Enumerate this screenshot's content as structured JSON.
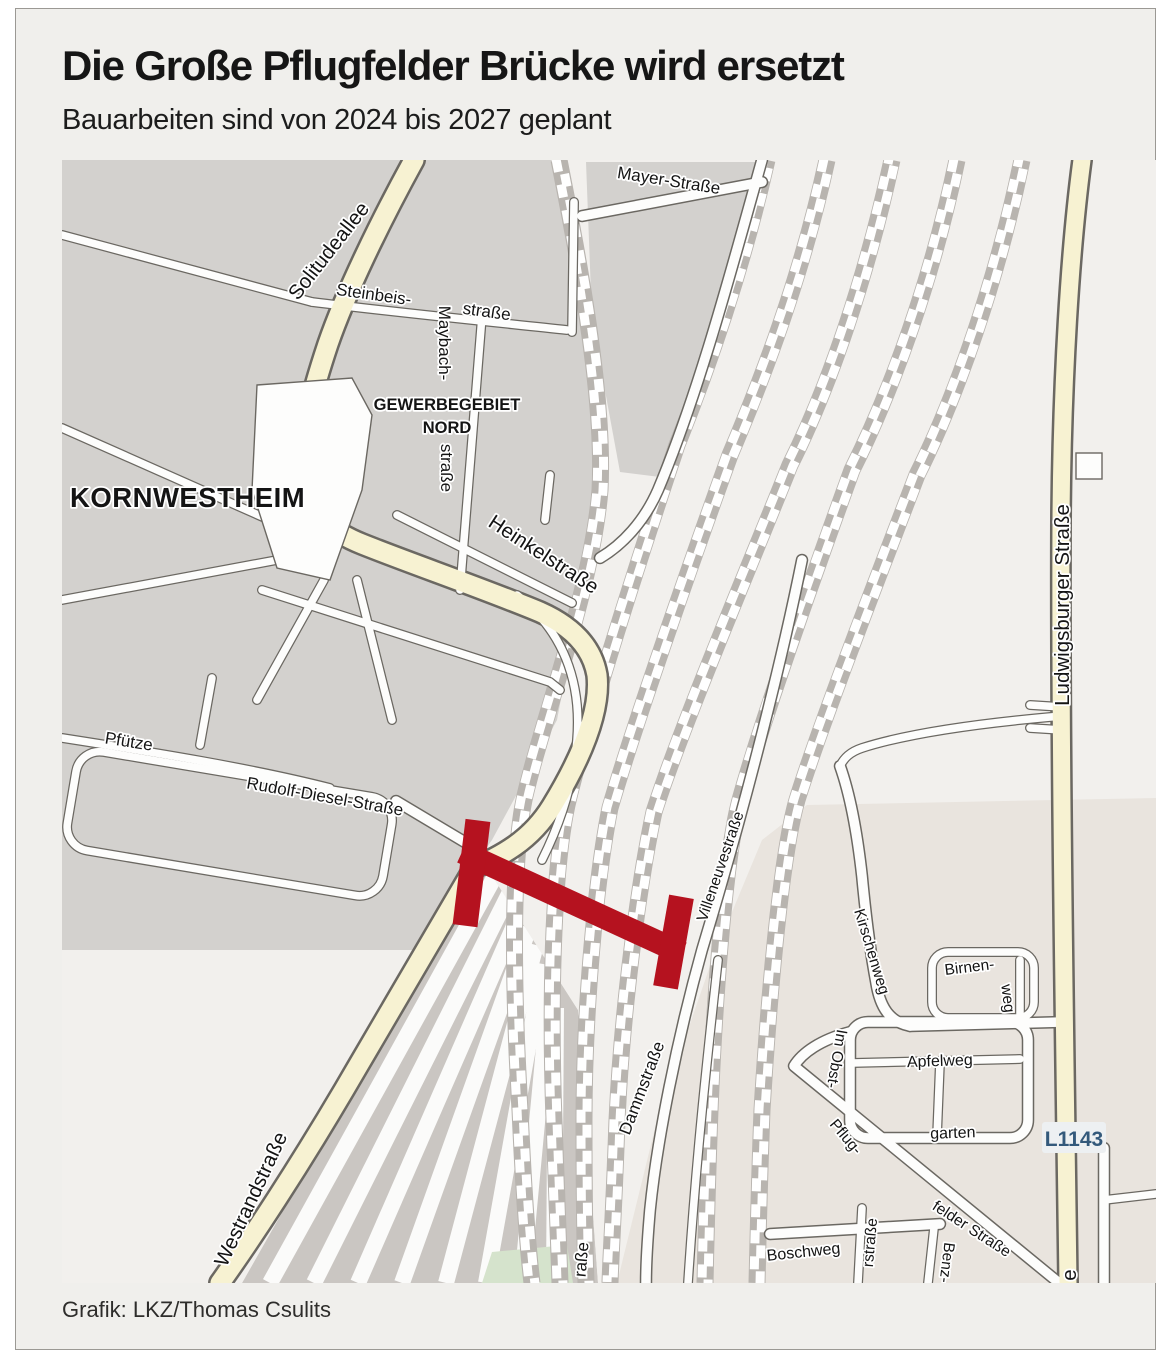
{
  "header": {
    "title": "Die Große Pflugfelder Brücke wird ersetzt",
    "subtitle": "Bauarbeiten sind von 2024 bis 2027 geplant"
  },
  "footer": {
    "credit": "Grafik: LKZ/Thomas Csulits"
  },
  "map": {
    "labels": [
      {
        "text": "Solitudeallee"
      },
      {
        "text": "Steinbeis-"
      },
      {
        "text": "straße"
      },
      {
        "text": "Maybach-"
      },
      {
        "text": "straße"
      },
      {
        "text": "Mayer-Straße"
      },
      {
        "text": "GEWERBEGEBIET"
      },
      {
        "text": "NORD"
      },
      {
        "text": "KORNWESTHEIM"
      },
      {
        "text": "Heinkelstraße"
      },
      {
        "text": "Ludwigsburger Straße"
      },
      {
        "text": "Pfütze"
      },
      {
        "text": "Rudolf-Diesel-Straße"
      },
      {
        "text": "Westrandstraße"
      },
      {
        "text": "Villeneuvestraße"
      },
      {
        "text": "Dammstraße"
      },
      {
        "text": "Kirschenweg"
      },
      {
        "text": "Im Obst-"
      },
      {
        "text": "Birnen-"
      },
      {
        "text": "weg"
      },
      {
        "text": "Apfelweg"
      },
      {
        "text": "garten"
      },
      {
        "text": "Pflug-"
      },
      {
        "text": "felder Straße"
      },
      {
        "text": "Boschweg"
      },
      {
        "text": "Benz-"
      },
      {
        "text": "rstraße"
      },
      {
        "text": "raße"
      },
      {
        "text": "e"
      },
      {
        "text": "L1143"
      }
    ],
    "colors": {
      "bridge_red": "#b5121f",
      "main_road_yellow": "#f7f2d2",
      "block_gray": "#d3d1ce",
      "residential_beige": "#e9e4de",
      "rail_gray": "#b8b4af",
      "route_badge_blue": "#33597b",
      "background": "#f0efec",
      "green_area": "#d5e3cc"
    }
  }
}
